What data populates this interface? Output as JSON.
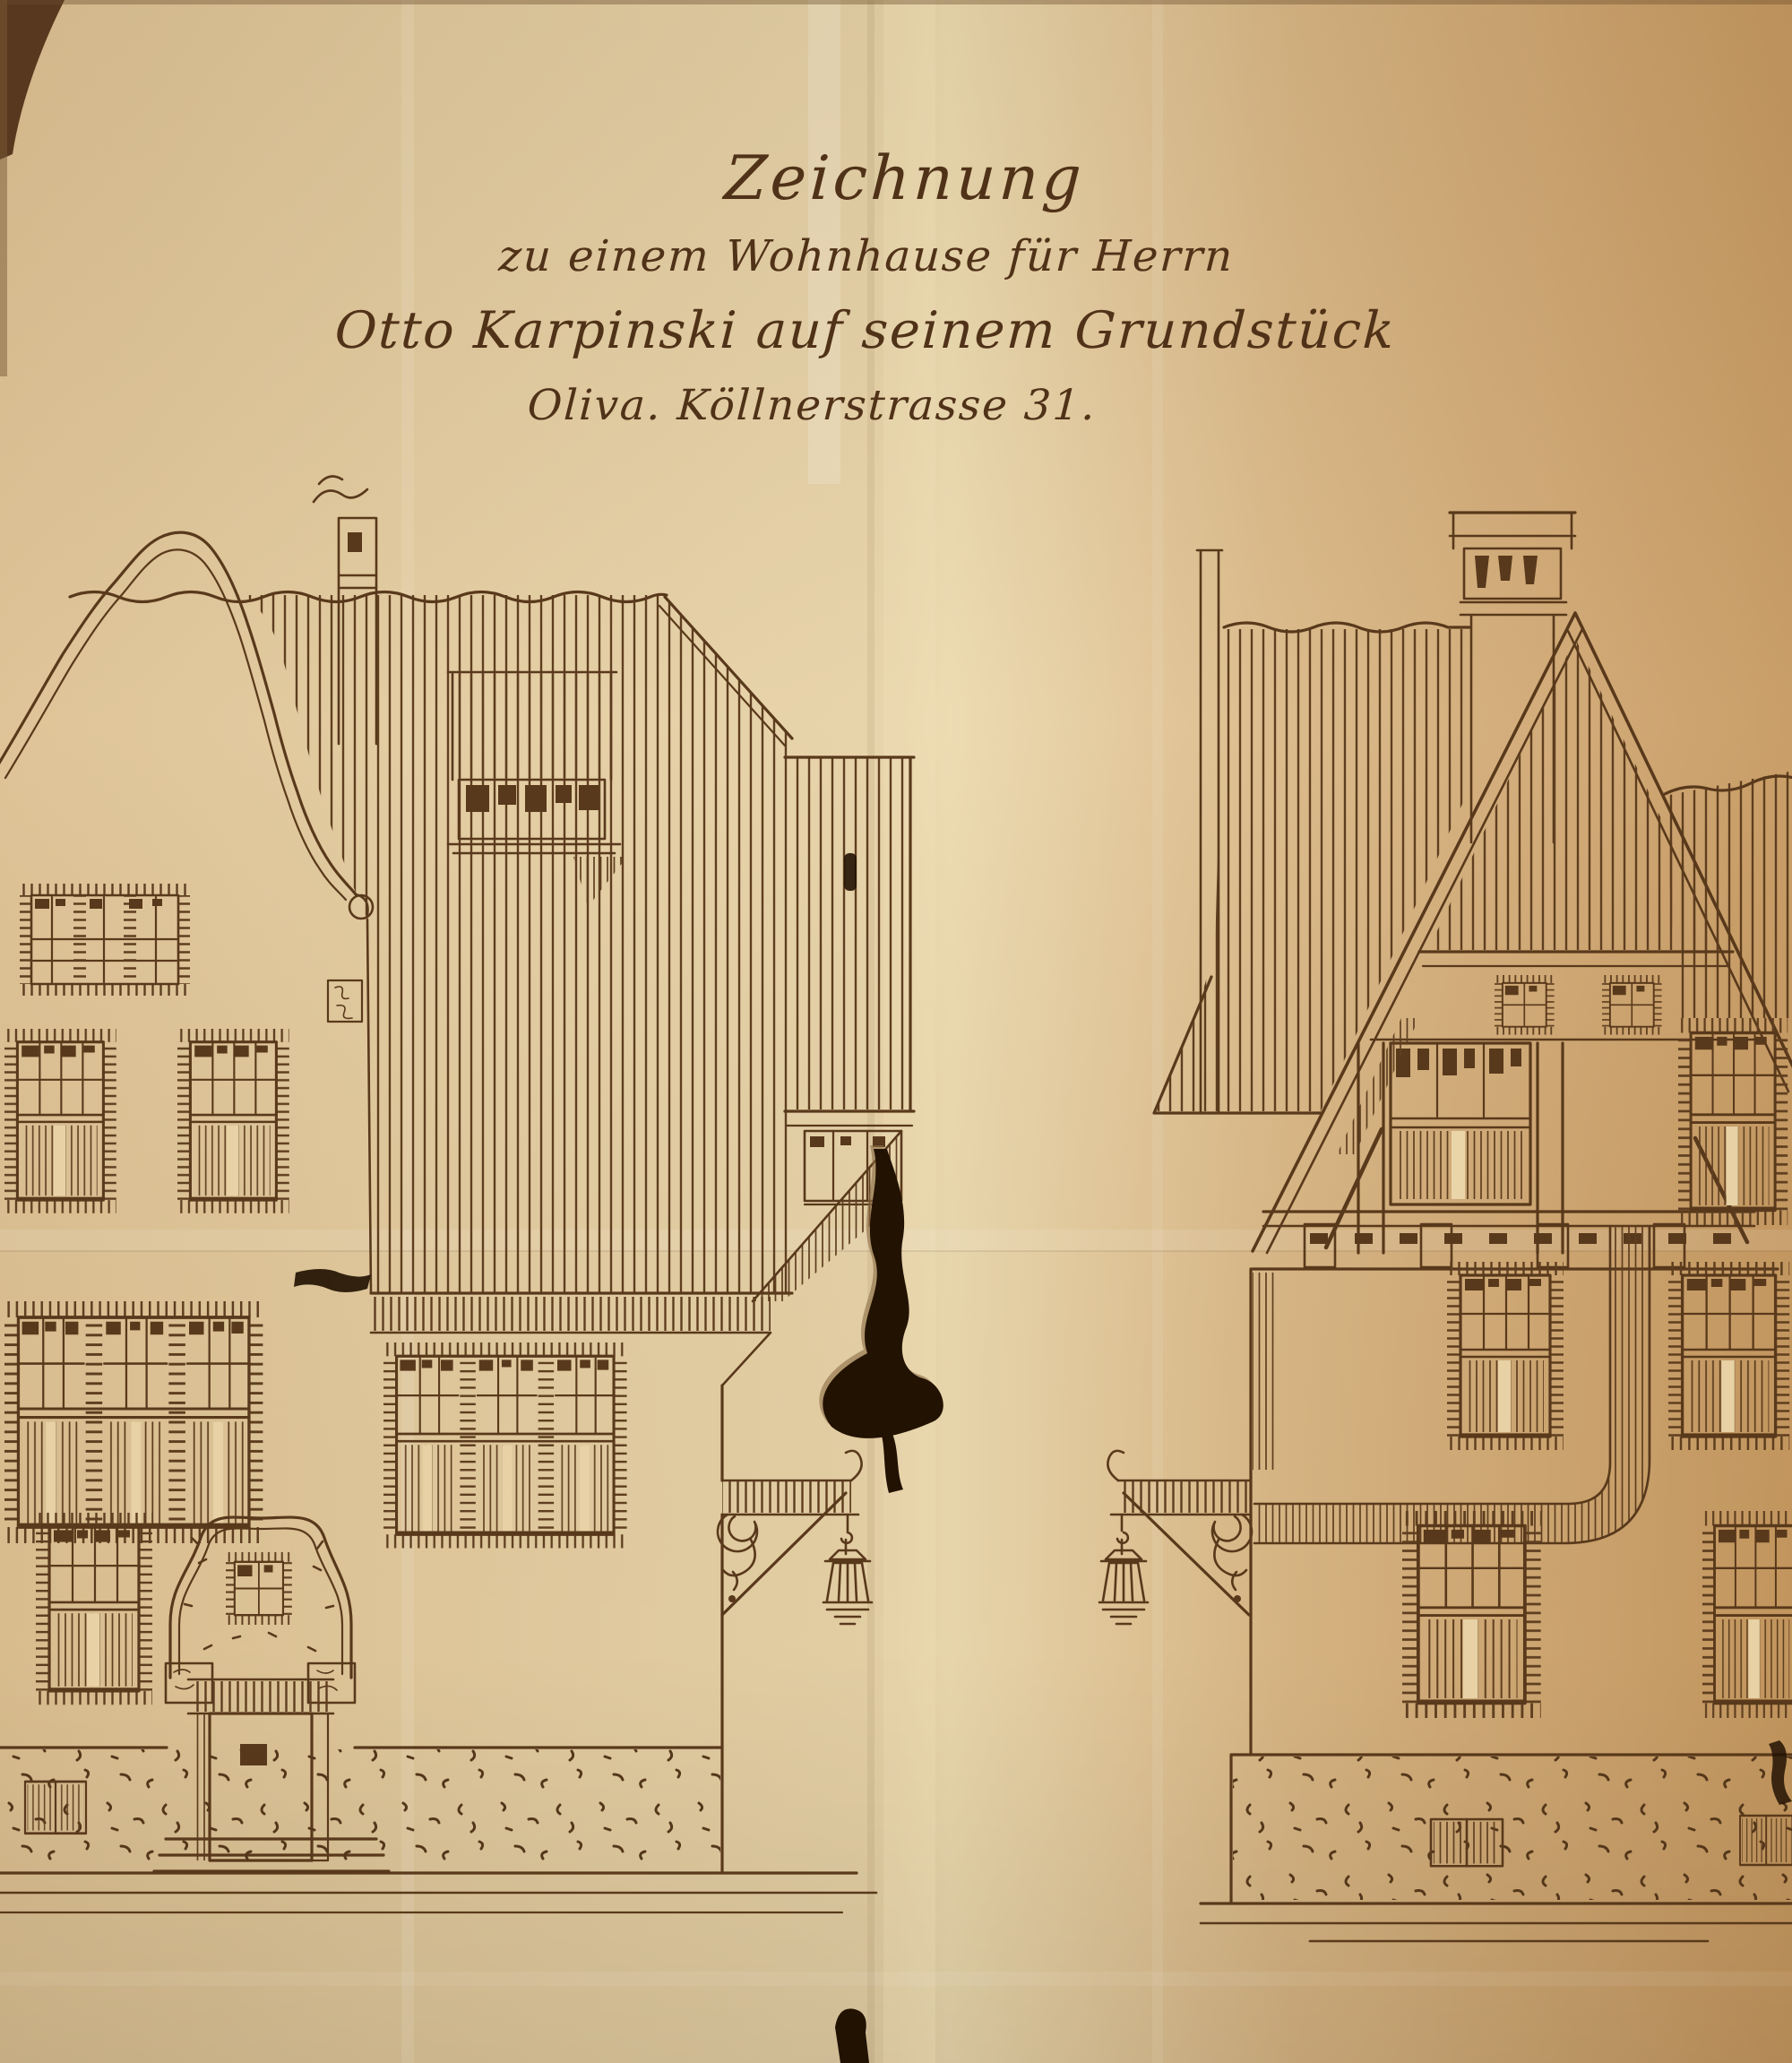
{
  "title_block": {
    "line1": "Zeichnung",
    "line2": "zu einem Wohnhause für Herrn",
    "line3": "Otto Karpinski auf seinem Grundstück",
    "line4": "Oliva. Köllnerstrasse 31."
  },
  "colors": {
    "paper": "#dfc08c",
    "paper_light": "#ecd9ae",
    "paper_shadow": "#c2945c",
    "ink": "#59391b",
    "tear_dark": "#221202"
  }
}
